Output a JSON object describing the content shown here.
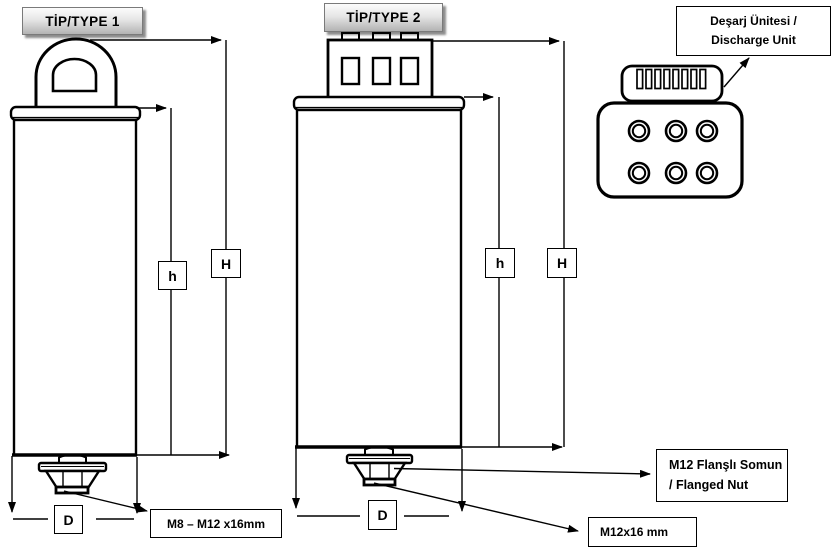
{
  "colors": {
    "ink": "#000000",
    "title_box_border": "#7a7a7a",
    "title_box_top": "#fcfcfc",
    "title_box_bottom": "#b3b3b3"
  },
  "type1": {
    "title": "TİP/TYPE 1",
    "dim_height_total": "H",
    "dim_height_body": "h",
    "dim_diameter": "D",
    "stud_label": "M8 – M12 x16mm"
  },
  "type2": {
    "title": "TİP/TYPE 2",
    "dim_height_total": "H",
    "dim_height_body": "h",
    "dim_diameter": "D",
    "stud_label": "M12x16 mm",
    "nut_label_line1": "M12 Flanşlı Somun",
    "nut_label_line2": "/ Flanged Nut"
  },
  "discharge_unit": {
    "label_line1": "Deşarj Ünitesi /",
    "label_line2": "Discharge Unit"
  }
}
